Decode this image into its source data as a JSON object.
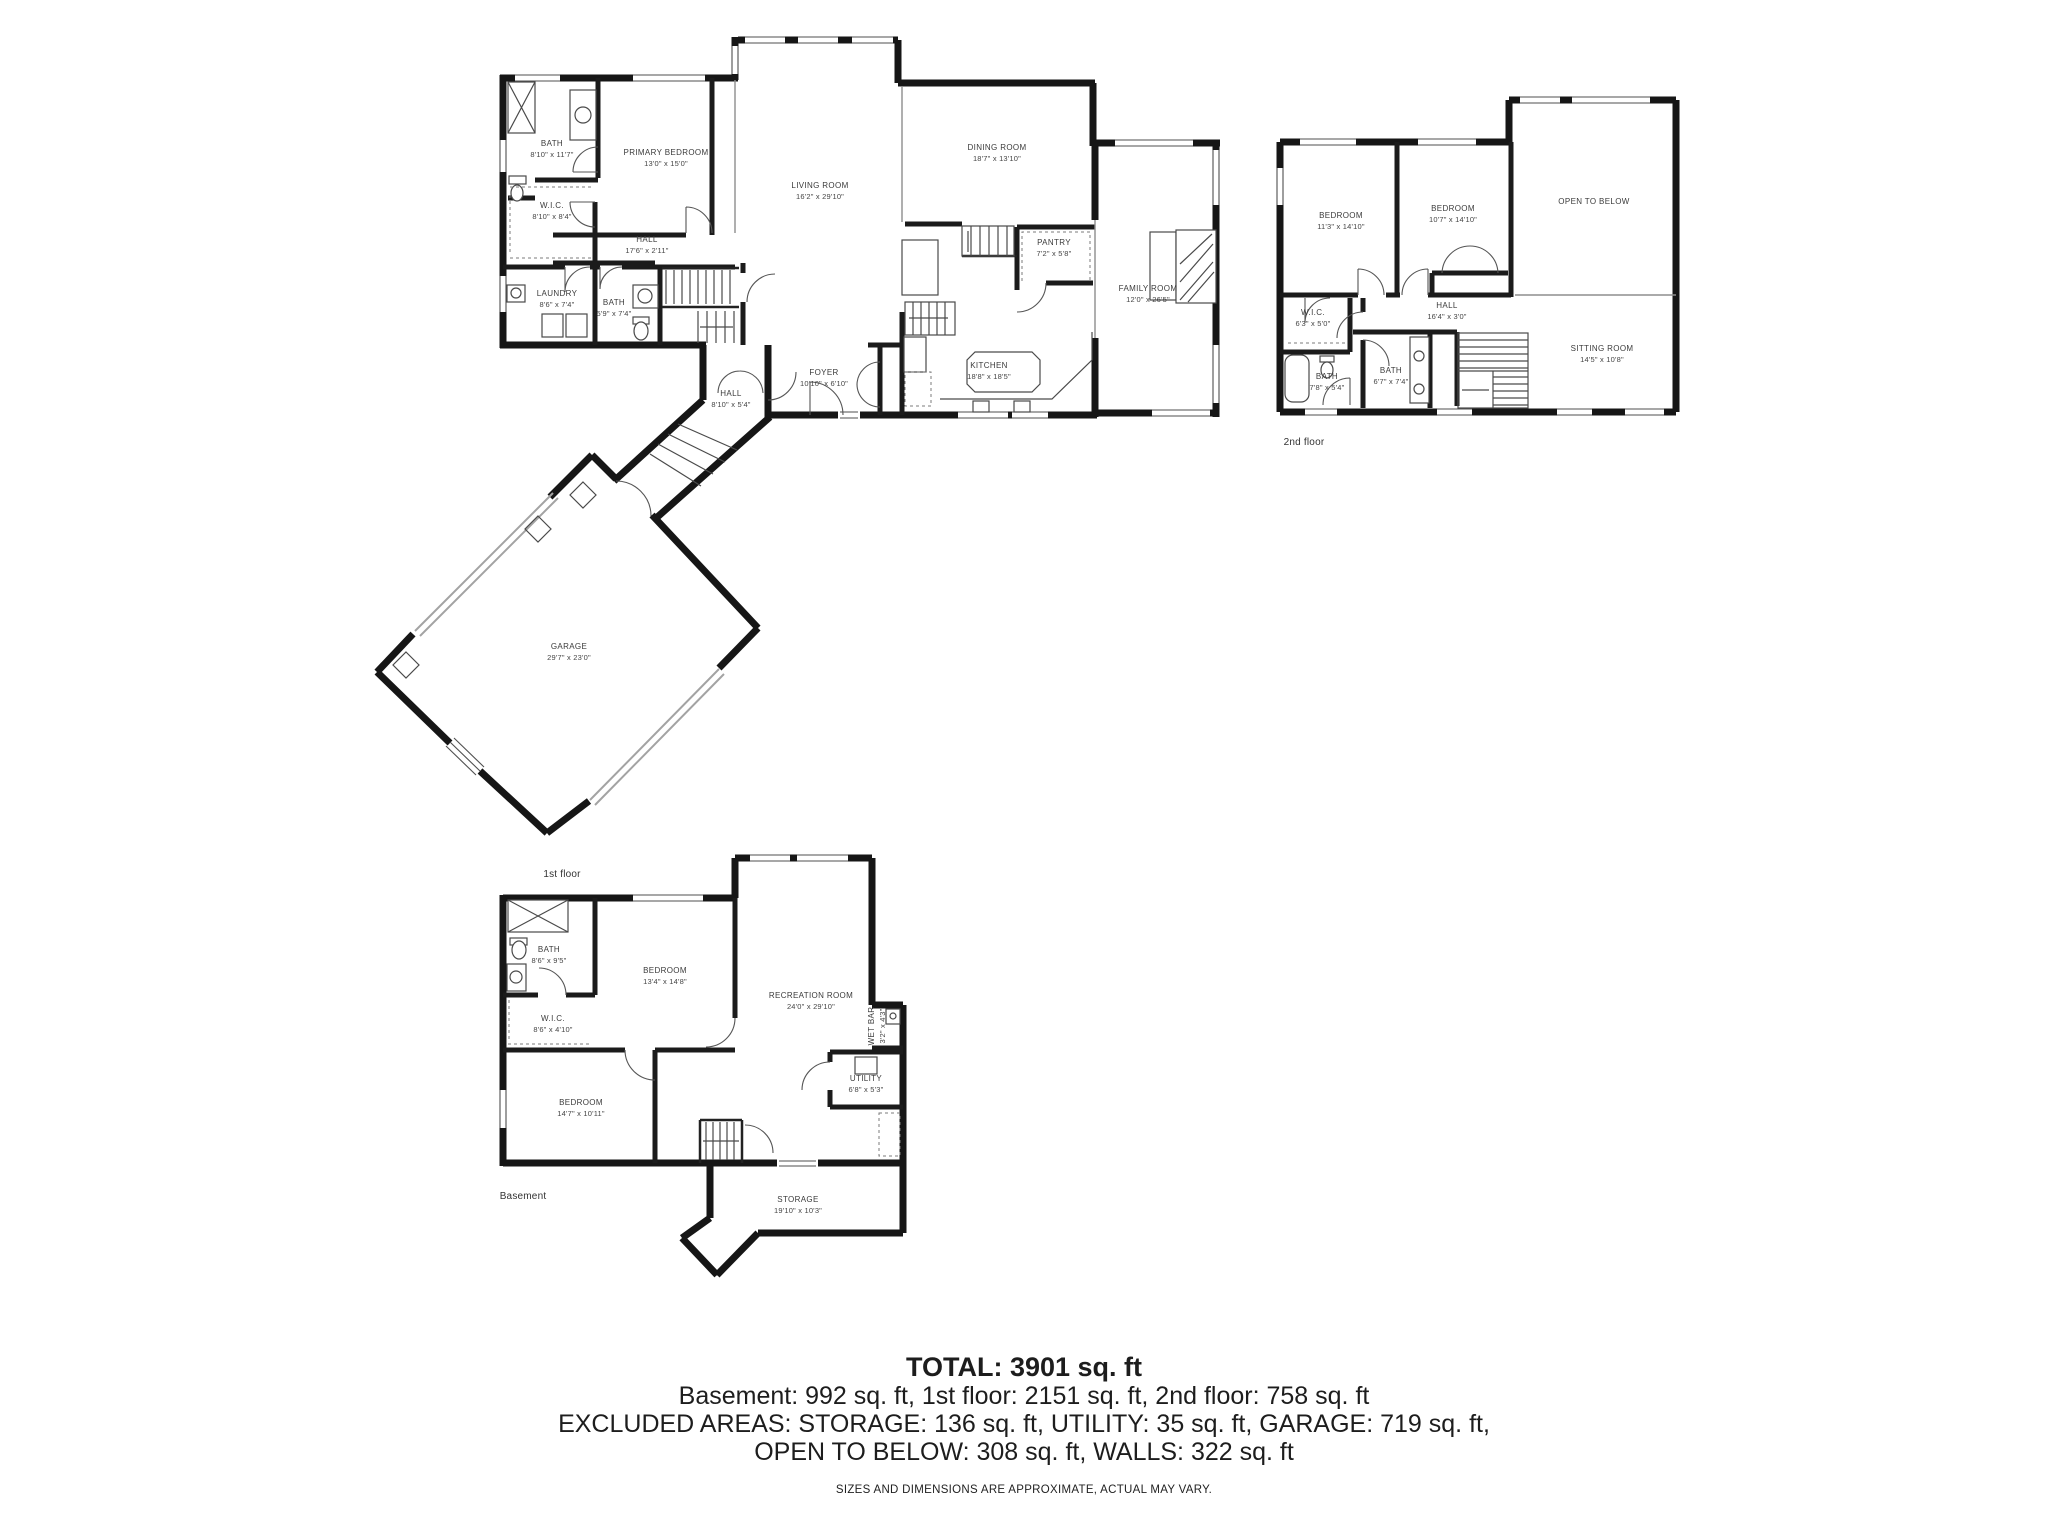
{
  "floors": {
    "first": {
      "caption": "1st floor",
      "rooms": [
        {
          "name": "BATH",
          "dims": "8'10\" x 11'7\""
        },
        {
          "name": "PRIMARY BEDROOM",
          "dims": "13'0\" x 15'0\""
        },
        {
          "name": "LIVING ROOM",
          "dims": "16'2\" x 29'10\""
        },
        {
          "name": "DINING ROOM",
          "dims": "18'7\" x 13'10\""
        },
        {
          "name": "PANTRY",
          "dims": "7'2\" x 5'8\""
        },
        {
          "name": "FAMILY ROOM",
          "dims": "12'0\" x 26'5\""
        },
        {
          "name": "W.I.C.",
          "dims": "8'10\" x 8'4\""
        },
        {
          "name": "HALL",
          "dims": "17'6\" x 2'11\""
        },
        {
          "name": "LAUNDRY",
          "dims": "8'6\" x 7'4\""
        },
        {
          "name": "BATH",
          "dims": "5'9\" x 7'4\""
        },
        {
          "name": "FOYER",
          "dims": "10'10\" x 6'10\""
        },
        {
          "name": "KITCHEN",
          "dims": "18'8\" x 18'5\""
        },
        {
          "name": "HALL",
          "dims": "8'10\" x 5'4\""
        },
        {
          "name": "GARAGE",
          "dims": "29'7\" x 23'0\""
        }
      ]
    },
    "second": {
      "caption": "2nd floor",
      "rooms": [
        {
          "name": "BEDROOM",
          "dims": "11'3\" x 14'10\""
        },
        {
          "name": "BEDROOM",
          "dims": "10'7\" x 14'10\""
        },
        {
          "name": "OPEN TO BELOW"
        },
        {
          "name": "W.I.C.",
          "dims": "6'3\" x 5'0\""
        },
        {
          "name": "HALL",
          "dims": "16'4\" x 3'0\""
        },
        {
          "name": "BATH",
          "dims": "7'8\" x 5'4\""
        },
        {
          "name": "BATH",
          "dims": "6'7\" x 7'4\""
        },
        {
          "name": "SITTING ROOM",
          "dims": "14'5\" x 10'8\""
        }
      ]
    },
    "basement": {
      "caption": "Basement",
      "rooms": [
        {
          "name": "BATH",
          "dims": "8'6\" x 9'5\""
        },
        {
          "name": "BEDROOM",
          "dims": "13'4\" x 14'8\""
        },
        {
          "name": "RECREATION ROOM",
          "dims": "24'0\" x 29'10\""
        },
        {
          "name": "W.I.C.",
          "dims": "8'6\" x 4'10\""
        },
        {
          "name": "BEDROOM",
          "dims": "14'7\" x 10'11\""
        },
        {
          "name": "WET BAR",
          "dims": "3'2\" x 4'3\""
        },
        {
          "name": "UTILITY",
          "dims": "6'8\" x 5'3\""
        },
        {
          "name": "STORAGE",
          "dims": "19'10\" x 10'3\""
        }
      ]
    }
  },
  "summary": {
    "total": "TOTAL: 3901 sq. ft",
    "line1": "Basement: 992 sq. ft, 1st floor: 2151 sq. ft, 2nd floor: 758 sq. ft",
    "line2": "EXCLUDED AREAS: STORAGE: 136 sq. ft, UTILITY: 35 sq. ft, GARAGE: 719 sq. ft,",
    "line3": "OPEN TO BELOW: 308 sq. ft, WALLS: 322 sq. ft",
    "disclaimer": "SIZES AND DIMENSIONS ARE APPROXIMATE, ACTUAL MAY VARY."
  }
}
